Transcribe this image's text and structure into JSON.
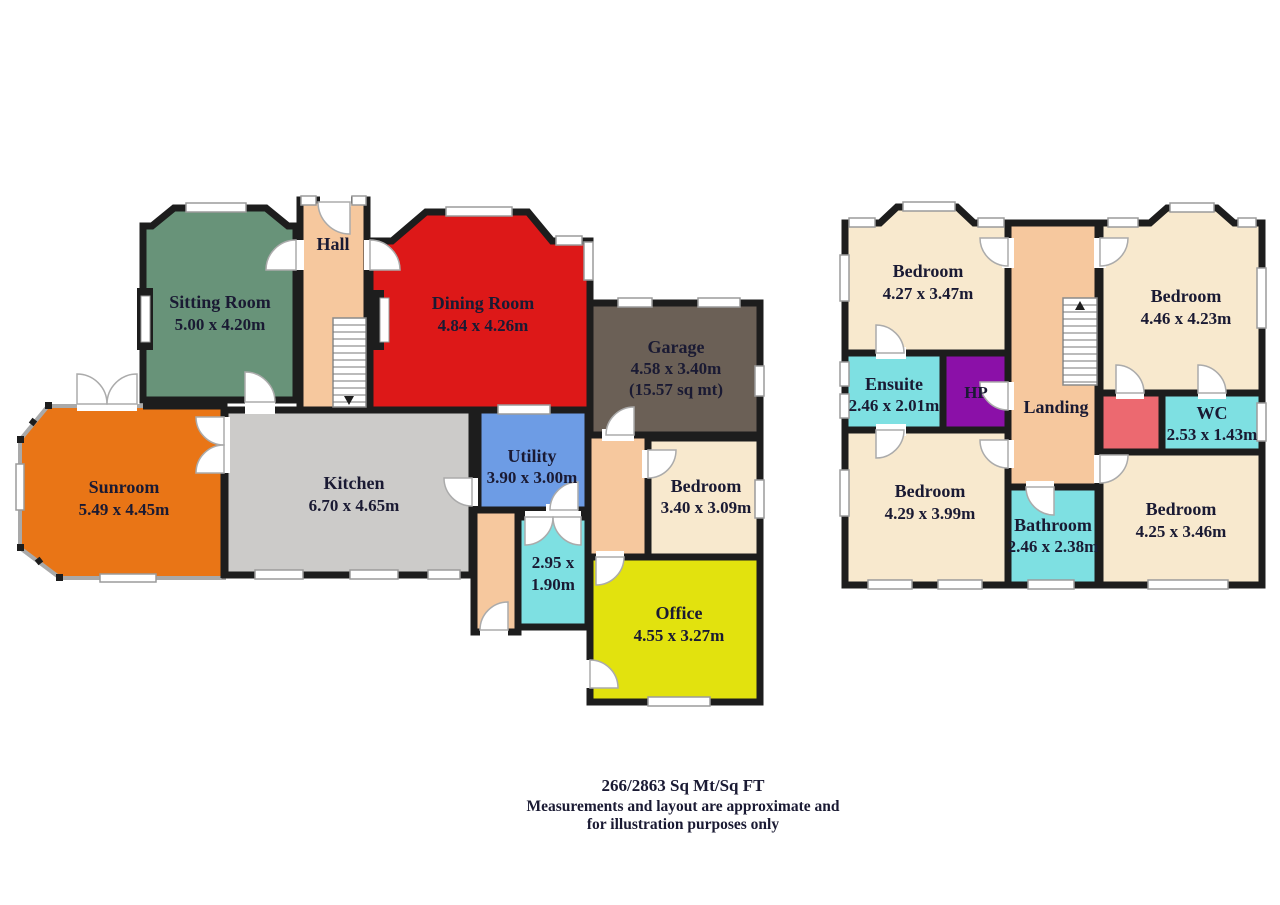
{
  "colors": {
    "wall": "#1d1d1d",
    "hall": "#f6c89e",
    "sitting": "#689379",
    "dining": "#dd1818",
    "garage": "#6b6056",
    "sunroom": "#e97516",
    "kitchen": "#cccbc9",
    "utility": "#6d9ce5",
    "bedroom_cream": "#f8e9ce",
    "cyan": "#7ee0e2",
    "office": "#e2e20e",
    "hp": "#8b10a8",
    "red_room": "#ec6970",
    "landing": "#f6c89e",
    "corridor": "#f6c89e",
    "text": "#1a1a33"
  },
  "ground_floor": {
    "rooms": {
      "sitting": {
        "name": "Sitting Room",
        "dims": "5.00 x 4.20m"
      },
      "hall": {
        "name": "Hall"
      },
      "dining": {
        "name": "Dining Room",
        "dims": "4.84 x 4.26m"
      },
      "garage": {
        "name": "Garage",
        "dims": "4.58 x 3.40m",
        "area": "(15.57 sq mt)"
      },
      "sunroom": {
        "name": "Sunroom",
        "dims": "5.49 x 4.45m"
      },
      "kitchen": {
        "name": "Kitchen",
        "dims": "6.70 x 4.65m"
      },
      "utility": {
        "name": "Utility",
        "dims": "3.90 x 3.00m"
      },
      "bedroom": {
        "name": "Bedroom",
        "dims": "3.40 x 3.09m"
      },
      "store": {
        "dims_line1": "2.95 x",
        "dims_line2": "1.90m"
      },
      "office": {
        "name": "Office",
        "dims": "4.55 x 3.27m"
      }
    }
  },
  "first_floor": {
    "rooms": {
      "bedroom_front_left": {
        "name": "Bedroom",
        "dims": "4.27 x 3.47m"
      },
      "landing": {
        "name": "Landing"
      },
      "bedroom_front_right": {
        "name": "Bedroom",
        "dims": "4.46 x 4.23m"
      },
      "ensuite": {
        "name": "Ensuite",
        "dims": "2.46 x 2.01m"
      },
      "hp": {
        "name": "HP"
      },
      "wc": {
        "name": "WC",
        "dims": "2.53 x 1.43m"
      },
      "bedroom_back_left": {
        "name": "Bedroom",
        "dims": "4.29 x 3.99m"
      },
      "bathroom": {
        "name": "Bathroom",
        "dims": "2.46 x 2.38m"
      },
      "bedroom_back_right": {
        "name": "Bedroom",
        "dims": "4.25 x 3.46m"
      }
    }
  },
  "footer": {
    "area_summary": "266/2863 Sq Mt/Sq FT",
    "disclaimer_line1": "Measurements and layout are approximate and",
    "disclaimer_line2": "for illustration purposes only"
  }
}
